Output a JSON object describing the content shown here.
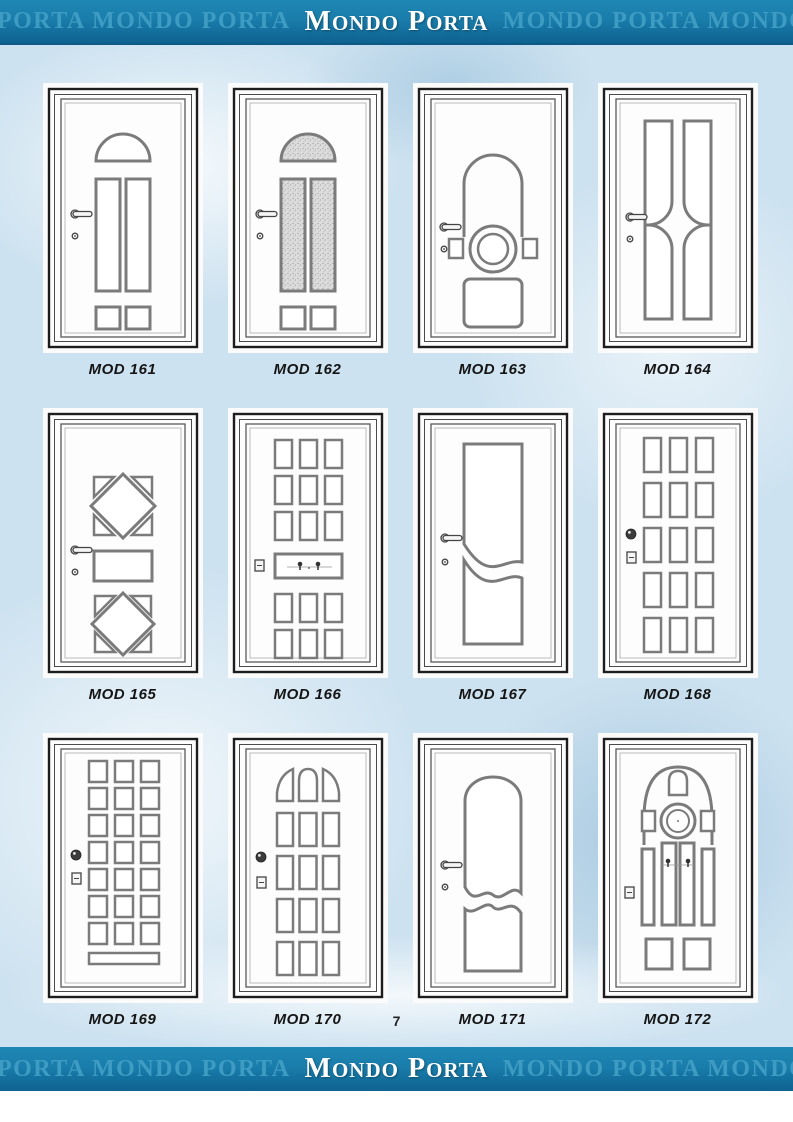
{
  "header": {
    "watermark_left": "PORTA MONDO PORTA",
    "logo": [
      {
        "initial": "M",
        "rest": "ONDO"
      },
      {
        "initial": "P",
        "rest": "ORTA"
      }
    ],
    "watermark_right": "MONDO PORTA MONDO"
  },
  "footer": {
    "watermark_left": "PORTA MONDO PORTA",
    "logo": [
      {
        "initial": "M",
        "rest": "ONDO"
      },
      {
        "initial": "P",
        "rest": "ORTA"
      }
    ],
    "watermark_right": "MONDO PORTA MONDO"
  },
  "page_number": "7",
  "colors": {
    "banner_bg": "#1a7dab",
    "banner_bg_dark": "#0e6290",
    "watermark_text": "#3e9cc3",
    "logo_text": "#ffffff",
    "page_bg": "#cde2f0",
    "label_text": "#151515"
  },
  "doors": [
    {
      "label": "MOD 161",
      "design": "fanlight-arch-two-tall-panels-two-squares",
      "hardware": "lever-handle-keyhole"
    },
    {
      "label": "MOD 162",
      "design": "glazed-fanlight-arch-two-glazed-tall-panels-two-squares",
      "hardware": "lever-handle-keyhole"
    },
    {
      "label": "MOD 163",
      "design": "round-arch-panel-center-ring-with-side-squares-bottom-panel",
      "hardware": "lever-handle-keyhole"
    },
    {
      "label": "MOD 164",
      "design": "four-tall-panels-central-circle-cutout",
      "hardware": "lever-handle-keyhole"
    },
    {
      "label": "MOD 165",
      "design": "two-diamonds-with-corner-triangles-center-rectangle",
      "hardware": "lever-handle-keyhole"
    },
    {
      "label": "MOD 166",
      "design": "panel-grid-3x3-wide-center-panel-with-knockers-panel-grid-3x2",
      "hardware": "edge-lock"
    },
    {
      "label": "MOD 167",
      "design": "two-tall-panels-s-curve-divider",
      "hardware": "lever-handle-keyhole"
    },
    {
      "label": "MOD 168",
      "design": "panel-grid-3x5",
      "hardware": "round-knob-edge-lock"
    },
    {
      "label": "MOD 169",
      "design": "square-grid-3x7-bottom-strip",
      "hardware": "round-knob-edge-lock"
    },
    {
      "label": "MOD 170",
      "design": "arched-top-row-panel-grid-3x4",
      "hardware": "round-knob-edge-lock"
    },
    {
      "label": "MOD 171",
      "design": "ornate-arched-panel-over-wavy-panel",
      "hardware": "lever-handle-keyhole"
    },
    {
      "label": "MOD 172",
      "design": "arch-with-center-ring-radial-panels-two-bottom-squares",
      "hardware": "edge-lock-twin-knockers"
    }
  ]
}
